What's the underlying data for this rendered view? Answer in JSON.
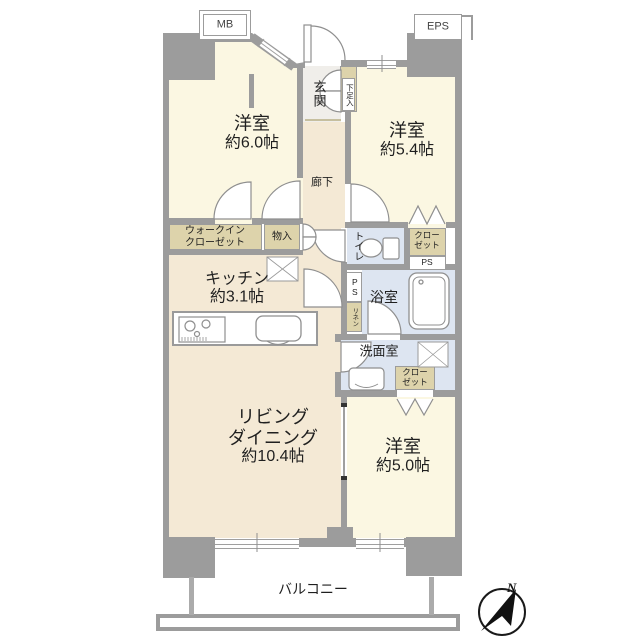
{
  "rooms": {
    "bedroom1": {
      "label": "洋室",
      "area": "約6.0帖"
    },
    "bedroom2": {
      "label": "洋室",
      "area": "約5.4帖"
    },
    "bedroom3": {
      "label": "洋室",
      "area": "約5.0帖"
    },
    "living": {
      "line1": "リビング",
      "line2": "ダイニング",
      "area": "約10.4帖"
    },
    "kitchen": {
      "label": "キッチン",
      "area": "約3.1帖"
    },
    "entrance": {
      "label": "玄関"
    },
    "corridor": {
      "label": "廊下"
    },
    "toilet": {
      "label": "トイレ"
    },
    "bath": {
      "label": "浴室"
    },
    "washroom": {
      "label": "洗面室"
    },
    "balcony": {
      "label": "バルコニー"
    }
  },
  "storage": {
    "wic_line1": "ウォークイン",
    "wic_line2": "クローゼット",
    "shoe": "下足入",
    "mono": "物入",
    "closet_line1": "クロー",
    "closet_line2": "ゼット",
    "linen": "リネン"
  },
  "utility": {
    "mb": "MB",
    "eps": "EPS",
    "ps": "PS"
  },
  "compass": {
    "north": "N"
  },
  "colors": {
    "wall": "#9c9c9c",
    "bedroom_floor": "#fbf7e2",
    "wood_floor": "#f4e9d5",
    "wet_floor": "#dde5f1",
    "entrance_floor": "#f0eeea",
    "closet_fill": "#ddd3ab",
    "text": "#1f1f1f"
  },
  "icons": {
    "entrance_door": "quarter-arc",
    "toilet": "bowl-and-tank",
    "bathtub": "rounded-rect",
    "stove": "burner-circles",
    "kitchen_sink": "rounded-rect",
    "washbasin": "rounded-rect",
    "washing_machine_pan": "x-box",
    "refrigerator_space": "x-box",
    "compass": "north-arrow"
  }
}
